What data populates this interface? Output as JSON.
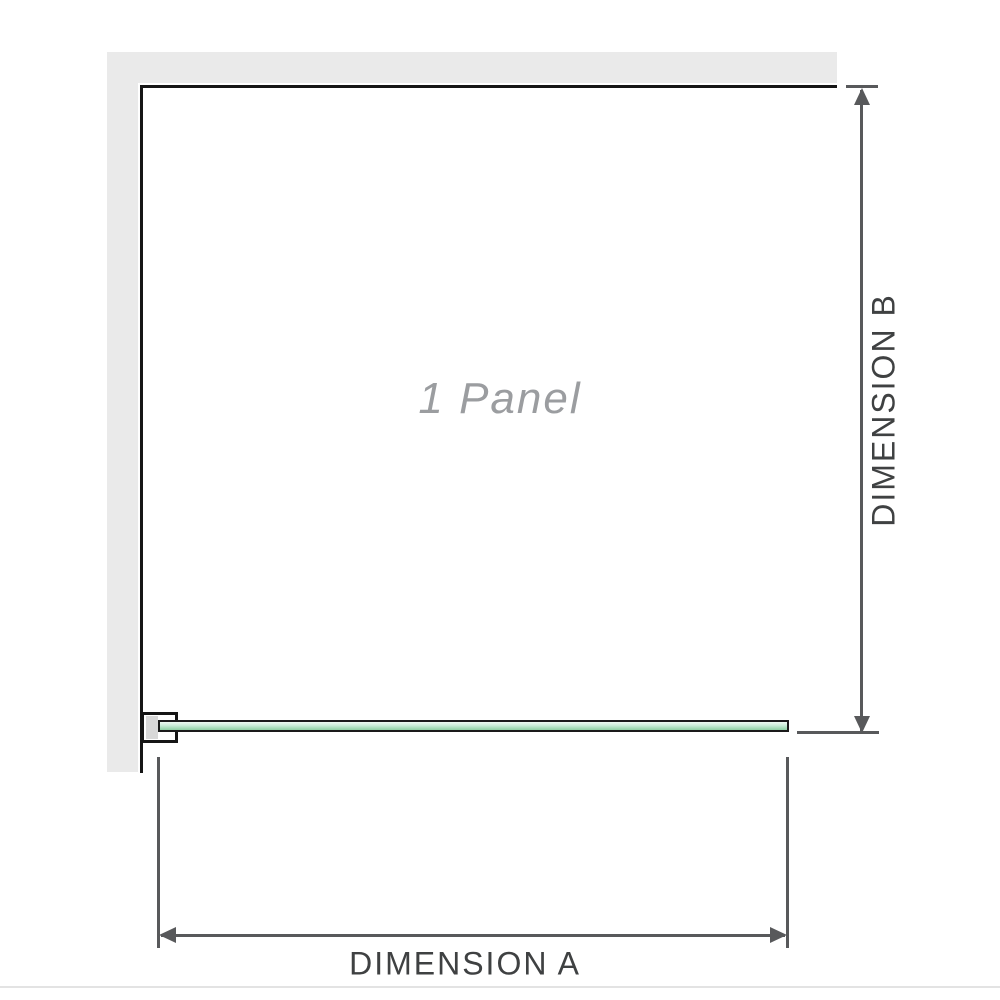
{
  "diagram": {
    "panel_label": "1 Panel",
    "dimension_a_label": "DIMENSION A",
    "dimension_b_label": "DIMENSION B",
    "icons": {
      "arrow_up": "arrow-up-icon",
      "arrow_down": "arrow-down-icon",
      "arrow_left": "arrow-left-icon",
      "arrow_right": "arrow-right-icon"
    },
    "colors": {
      "wall": "#eaeaea",
      "panel_border": "#151515",
      "dimension_line": "#58595b",
      "label_text": "#3f4142",
      "panel_label_text": "#9b9da0",
      "glass_top": "#eef8f1",
      "glass_bottom": "#97d4ab",
      "glass_border": "#1a1a1a",
      "bracket_fill": "#d8d8d8",
      "separator": "#e3e3e3"
    }
  }
}
